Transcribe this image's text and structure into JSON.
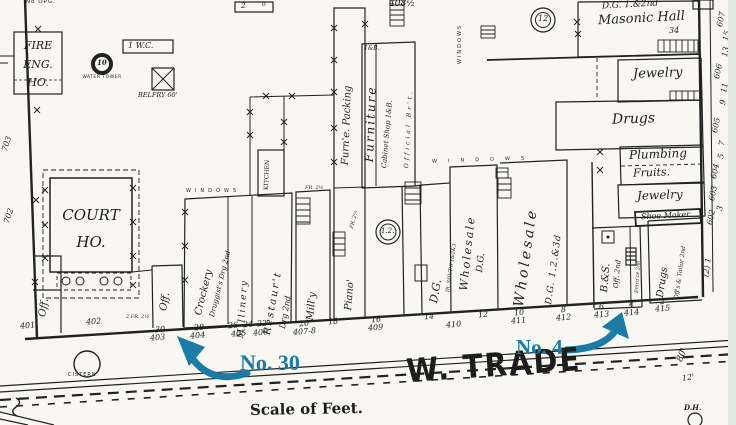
{
  "annotations": {
    "no30": "No. 30",
    "no4": "No. 4",
    "color": "#1a7ba6"
  },
  "street": {
    "name": "W. TRADE",
    "scale_label": "Scale of Feet.",
    "cistern": "CISTERN",
    "dh": "D.H.",
    "width_80": "80'",
    "width_12": "12'"
  },
  "labels": {
    "fire_1": "FIRE",
    "fire_2": "ENG.",
    "fire_3": "HO.",
    "water_tower": "WATER TOWER",
    "water_tower_num": "10",
    "wc": "1 W.C.",
    "belfry": "BELFRY 60'",
    "no_opg": "No OPG.",
    "court_1": "COURT",
    "court_2": "HO.",
    "off_left": "Off.",
    "off_mid": "Off.",
    "kitchen": "KITCHEN",
    "windows_1": "WINDOWS",
    "windows_2": "WINDOWS",
    "windows_3": "WINDOWS",
    "crockery_1": "Crockery",
    "crockery_2": "Druggist's Drg 2nd",
    "millinery": "Millinery",
    "restaurant_1": "Restaur't",
    "restaurant_2": "Drg 2nd",
    "milly": "Mill'y",
    "piano": "Piano'",
    "furn_packing": "Furn'e. Packing",
    "furniture": "Furniture",
    "cabinet_shop": "Cabinet Shop 1&B.",
    "official_brt": "Official Br't.",
    "dg": "D.G.",
    "iron_shutters": "IR. SHUT'S 1&2&3",
    "wholesale1_1": "Wholesale",
    "wholesale1_2": "D.G.",
    "wholesale2_1": "Wholesale",
    "wholesale2_2": "D.G. 1.2.&3d",
    "masonic_1": "D.G. 1.&2nd",
    "masonic_2": "Masonic Hall",
    "masonic_3": "34",
    "jewelry_1": "Jewelry",
    "drugs_1": "Drugs",
    "plumbing": "Plumbing",
    "fruits": "Fruits.",
    "jewelry_2": "Jewelry",
    "shoe_maker": "Shoe Maker",
    "bs": "B.&S.",
    "bs_off": "Off. 2nd",
    "entrance": "Entra'ce 2nd",
    "drugs_2": "Drugs",
    "tailor": "Off's & Tailor 2nd",
    "num_408": "408½",
    "one_b": "1&B.",
    "fr_a": "FR. 2½",
    "fr_b": "FR. 2½",
    "fr_c": "2 FR. 2½",
    "circle_12": "12",
    "circle_1_2": "1.2.",
    "box_2": "2",
    "box_o": "o"
  },
  "numbers": {
    "front": [
      "401",
      "402",
      "30",
      "403",
      "28",
      "404",
      "26",
      "24",
      "22",
      "405",
      "406",
      "20",
      "407-8",
      "18",
      "16",
      "409",
      "14",
      "410",
      "12",
      "10",
      "411",
      "8",
      "412",
      "6",
      "413",
      "4",
      "414",
      "2",
      "415"
    ],
    "right_edge": [
      "607",
      "15",
      "13",
      "606",
      "11",
      "9",
      "605",
      "7",
      "5",
      "604",
      "603",
      "3",
      "602",
      "1",
      "(2)"
    ],
    "left_edge": [
      "703",
      "702"
    ]
  }
}
